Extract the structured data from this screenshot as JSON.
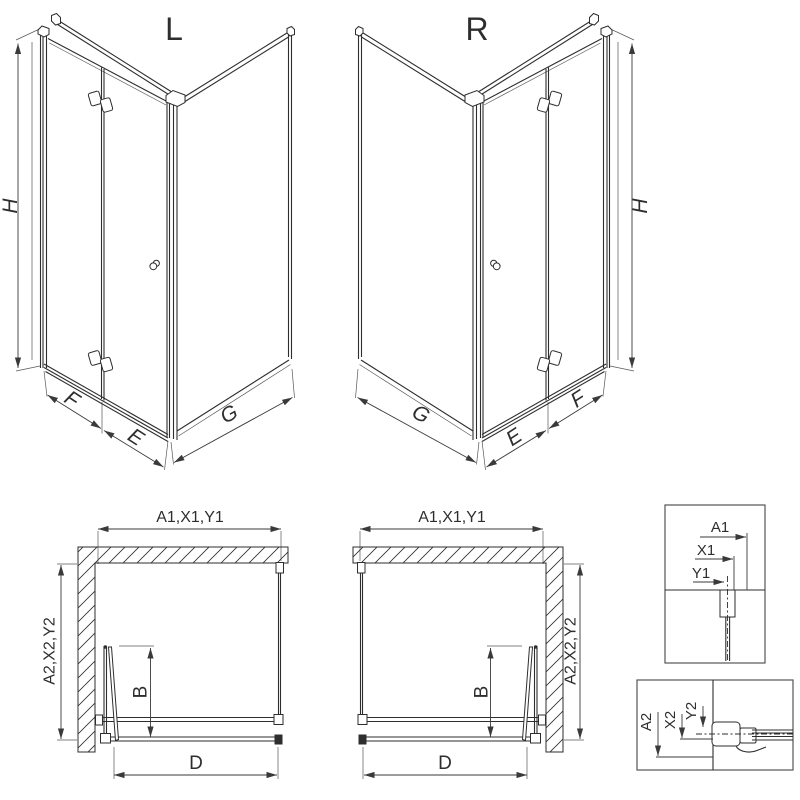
{
  "colors": {
    "line": "#2e2e2e",
    "dim": "#3a3a3a",
    "background": "#ffffff"
  },
  "views": {
    "iso_left": {
      "variant_label": "L",
      "dim_height": "H",
      "dim_door_panel": "F",
      "dim_door_fixed": "E",
      "dim_side_panel": "G"
    },
    "iso_right": {
      "variant_label": "R",
      "dim_height": "H",
      "dim_door_panel": "F",
      "dim_door_fixed": "E",
      "dim_side_panel": "G"
    },
    "plan_left": {
      "dim_width_top": "A1,X1,Y1",
      "dim_depth_side": "A2,X2,Y2",
      "dim_door_projection": "B",
      "dim_entry_width": "D"
    },
    "plan_right": {
      "dim_width_top": "A1,X1,Y1",
      "dim_depth_side": "A2,X2,Y2",
      "dim_door_projection": "B",
      "dim_entry_width": "D"
    },
    "detail_top": {
      "dims": [
        "A1",
        "X1",
        "Y1"
      ]
    },
    "detail_bottom": {
      "dims": [
        "A2",
        "X2",
        "Y2"
      ]
    }
  }
}
